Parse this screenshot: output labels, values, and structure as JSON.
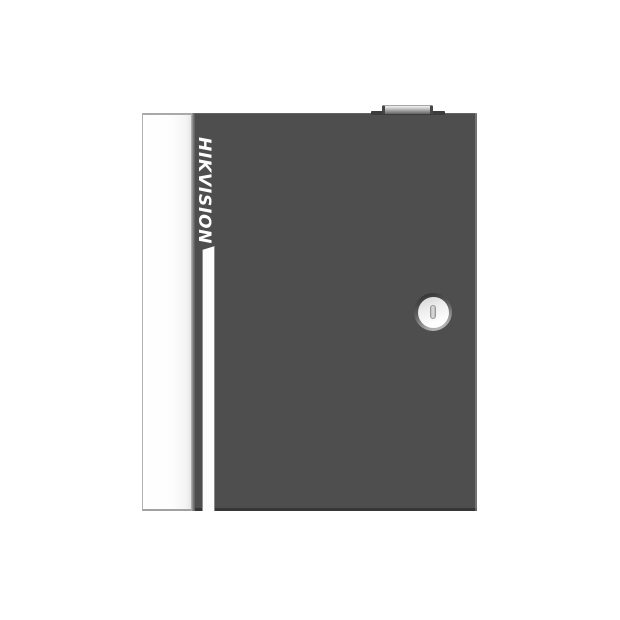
{
  "scene": {
    "type": "product-photo",
    "background_color": "#ffffff"
  },
  "device": {
    "brand": "HIKVISION",
    "body_color": "#4e4e4e",
    "side_panel_color": "#fdfdfd",
    "accent_stripe_color": "#fdfdfd",
    "panel_border_color": "#b3b3b3",
    "bottom_edge_color": "#3a3a3a",
    "right_edge_highlight_color": "#8a8a8a",
    "latch": {
      "base_color": "#3c3c3c",
      "knob_highlight_color": "#f2f2f2",
      "knob_shadow_color": "#646464"
    },
    "lock": {
      "ring_dark_color": "#333333",
      "ring_light_color": "#c9c9c9",
      "face_color": "#ffffff",
      "slot_fill_color": "#dedede",
      "slot_border_color": "#969696"
    }
  }
}
